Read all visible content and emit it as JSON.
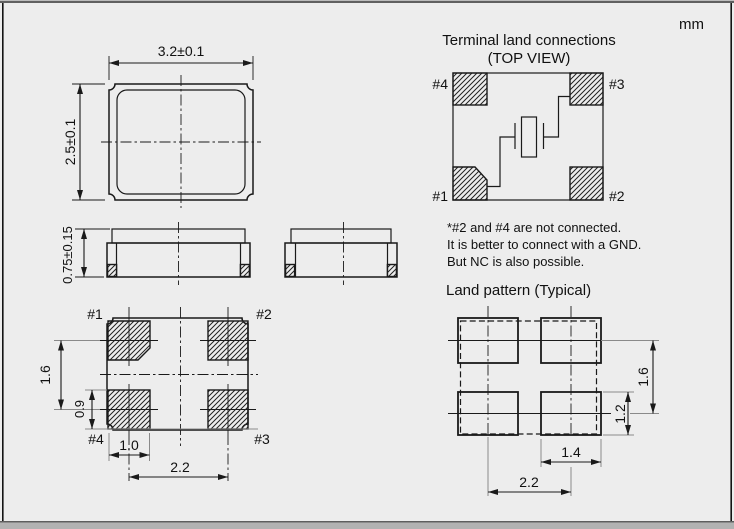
{
  "frame": {
    "unit_label": "mm"
  },
  "colors": {
    "background": "#ededed",
    "line": "#1a1a1a",
    "extension_line": "#8a8a8a"
  },
  "top_view": {
    "width_dim": "3.2±0.1",
    "height_dim": "2.5±0.1"
  },
  "side_view": {
    "thickness_dim": "0.75±0.15"
  },
  "bottom_view": {
    "pin1": "#1",
    "pin2": "#2",
    "pin3": "#3",
    "pin4": "#4",
    "dim_pad_pitch_y": "1.6",
    "dim_pad_height": "0.9",
    "dim_pad_width": "1.0",
    "dim_pad_pitch_x": "2.2"
  },
  "terminal_connections": {
    "title": "Terminal land connections",
    "subtitle": "(TOP VIEW)",
    "pin1": "#1",
    "pin2": "#2",
    "pin3": "#3",
    "pin4": "#4",
    "note_line1": "*#2 and #4 are not connected.",
    "note_line2": "It is better to connect with a GND.",
    "note_line3": "But NC is also possible."
  },
  "land_pattern": {
    "title": "Land pattern (Typical)",
    "dim_pad_pitch_y": "1.6",
    "dim_pad_height": "1.2",
    "dim_pad_width": "1.4",
    "dim_pad_pitch_x": "2.2"
  }
}
